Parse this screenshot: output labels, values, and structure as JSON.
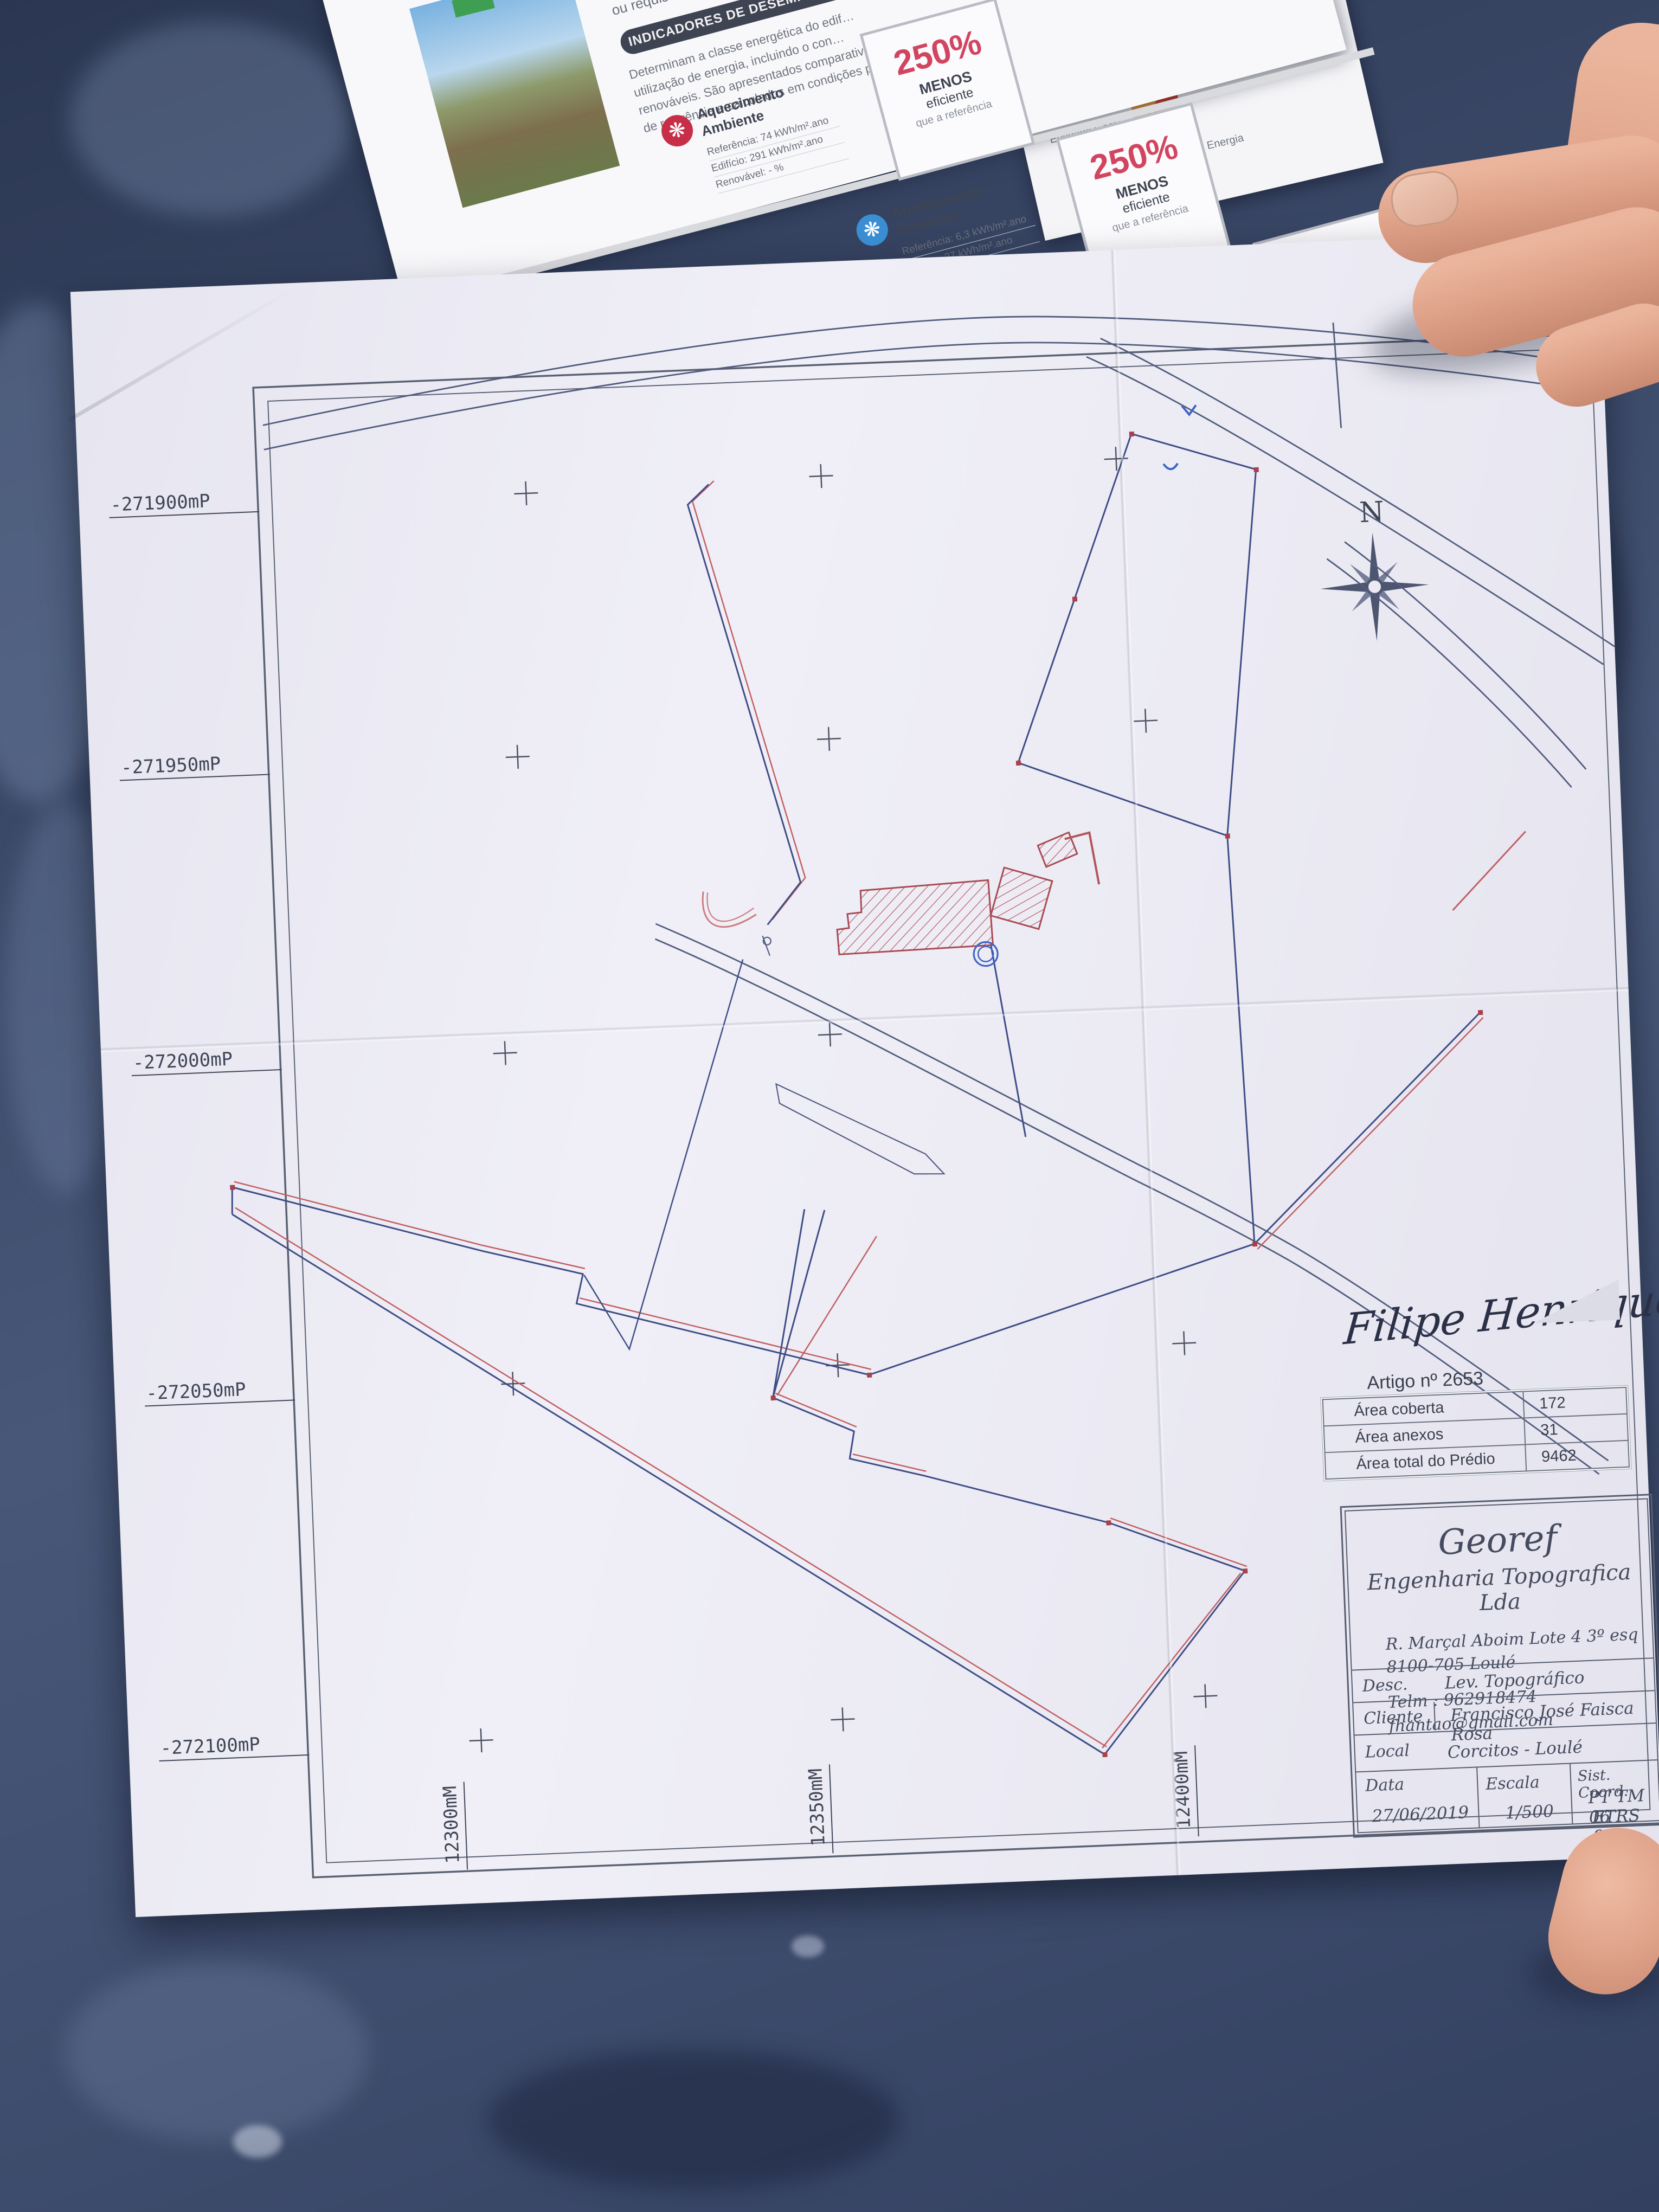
{
  "brochure": {
    "intro_lines": [
      "Este certificado apresenta a cl…",
      "energético deste edifício nas con…",
      "ou requisitos aplicáveis para o an…"
    ],
    "badge": "INDICADORES DE DESEMPENHO",
    "body_lines": [
      "Determinam a classe energética do edif…",
      "utilização de energia, incluindo o con…",
      "renováveis. São apresentados comparativ…",
      "de referência e calculados em condições p…"
    ],
    "indicators": [
      {
        "title_lines": [
          "Aquecimento",
          "Ambiente"
        ],
        "rows": [
          {
            "label": "Referência:",
            "value": "74 kWh/m².ano"
          },
          {
            "label": "Edifício:",
            "value": "291 kWh/m².ano"
          },
          {
            "label": "Renovável:",
            "value": "- %"
          }
        ],
        "pct": "250%",
        "pct_lines": [
          "MENOS",
          "eficiente",
          "que a referência"
        ]
      },
      {
        "title_lines": [
          "Arrefecimento",
          "Ambiente"
        ],
        "rows": [
          {
            "label": "Referência:",
            "value": "6,3 kWh/m².ano"
          },
          {
            "label": "Edifício:",
            "value": "27 kWh/m².ano"
          },
          {
            "label": "Renovável:",
            "value": "- %"
          }
        ],
        "pct": "250%",
        "pct_lines": [
          "MENOS",
          "eficiente",
          "que a referência"
        ]
      },
      {
        "title_lines": [
          "Água Quente",
          "Sanitária"
        ],
        "rows": [
          {
            "label": "Referência:",
            "value": "19 kWh/m².ano"
          },
          {
            "label": "Edifício:",
            "value": "21 kWh/m².ano"
          },
          {
            "label": "Renovável:",
            "value": "- %"
          }
        ],
        "pct": "11%",
        "pct_lines": [
          "MENOS",
          "eficiente",
          "que a referência"
        ]
      }
    ],
    "panel2": {
      "fisc_label": "Entidade Fiscalizadora",
      "fisc_name_lines": [
        "Direção Geral",
        "de Energia e Geologia"
      ],
      "gest_label": "Entidade Gestora",
      "gest_name": "adene",
      "gest_sub": "Agência para a Energia"
    }
  },
  "map": {
    "north_label": "N",
    "coord_labels_left": [
      "-271900mP",
      "-271950mP",
      "-272000mP",
      "-272050mP",
      "-272100mP"
    ],
    "coord_labels_bottom": [
      "12300mM",
      "12350mM",
      "12400mM"
    ],
    "signature": "Filipe Henriques",
    "artigo": {
      "title": "Artigo nº 2653",
      "rows": [
        {
          "label": "Área coberta",
          "value": "172"
        },
        {
          "label": "Área anexos",
          "value": "31"
        },
        {
          "label": "Área total do Prédio",
          "value": "9462"
        }
      ]
    },
    "title_block": {
      "company": "Georef",
      "company_sub": "Engenharia Topografica Lda",
      "address1": "R. Marçal Aboim Lote 4 3º esq",
      "address2": "8100-705 Loulé",
      "phone": "Telm : 962918474",
      "email": "fhantao@gmail.com",
      "desc_label": "Desc.",
      "desc_value": "Lev. Topográfico",
      "cliente_label": "Cliente",
      "cliente_value": "Francisco José Faisca Rosa",
      "local_label": "Local",
      "local_value": "Corcitos - Loulé",
      "data_label": "Data",
      "data_value": "27/06/2019",
      "escala_label": "Escala",
      "escala_value": "1/500",
      "coord_label": "Sist. Coord.",
      "coord_value1": "PT TM 06",
      "coord_value2": "ETRS 89"
    },
    "colors": {
      "boundary_blue": "#3e4d86",
      "boundary_red": "#c25f63",
      "frame": "#5a6173",
      "circle_blue": "#3f64c8"
    }
  }
}
